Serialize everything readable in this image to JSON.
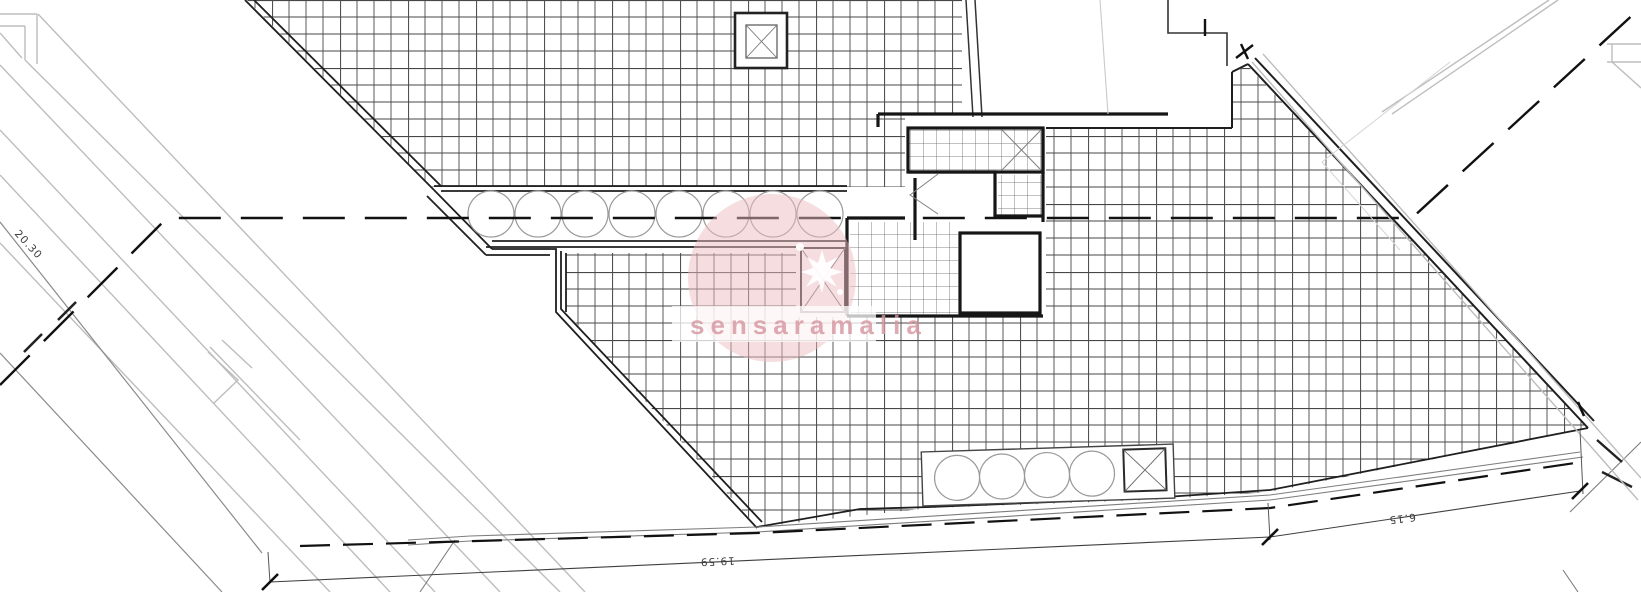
{
  "drawing": {
    "type_label": "architectural-roof-plan",
    "dimensions": {
      "left": "20.30",
      "bottom": "19.59",
      "bottom_right": "6.15"
    },
    "watermark": {
      "text": "sensaramalia",
      "accent_color": "#e8b7bd"
    },
    "colors": {
      "line_dark": "#1a1a1a",
      "line_mid": "#4a4a4a",
      "line_light": "#b5b5b5",
      "hatch_major": "#b3b3b3",
      "watermark_pink": "#eebcc2"
    }
  }
}
